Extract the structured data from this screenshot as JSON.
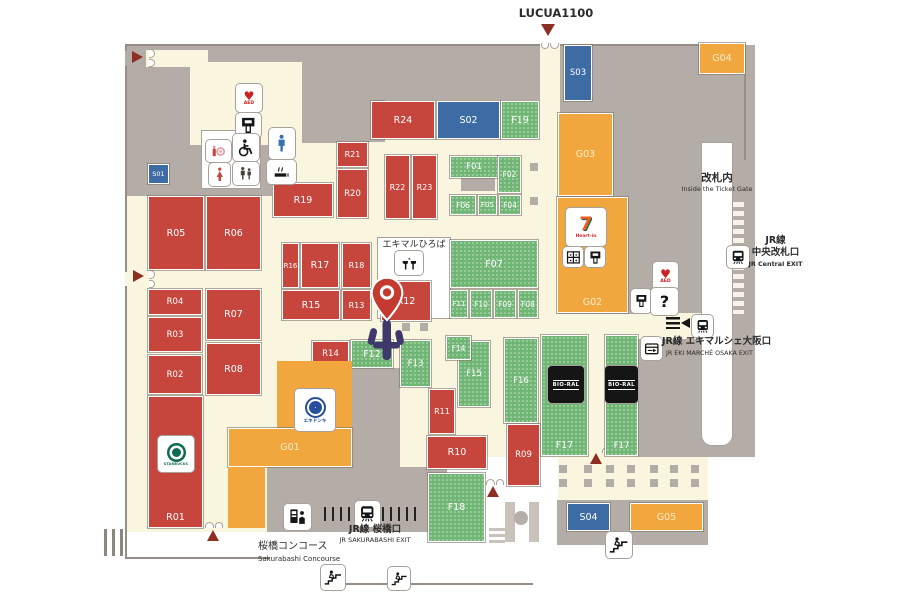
{
  "colors": {
    "red": "#c6463e",
    "green": "#6fb573",
    "blue": "#3d6ba3",
    "orange": "#f1a73e",
    "gray": "#b4aca6",
    "cream": "#faf5de",
    "arrow": "#8e2f23"
  },
  "icon_glyphs": {
    "question": "?",
    "aed_heart": "♥",
    "aed_label": "AED"
  },
  "regions": [
    {
      "c": "cream",
      "x": 125,
      "y": 45,
      "w": 630,
      "h": 487,
      "n": "map-base"
    },
    {
      "c": "gray",
      "x": 125,
      "y": 45,
      "w": 415,
      "h": 55,
      "n": "backarea-top"
    },
    {
      "c": "gray",
      "x": 125,
      "y": 68,
      "w": 65,
      "h": 128,
      "n": "backarea-left"
    },
    {
      "c": "gray",
      "x": 302,
      "y": 100,
      "w": 35,
      "h": 43,
      "n": "backarea-a"
    },
    {
      "c": "gray",
      "x": 337,
      "y": 100,
      "w": 48,
      "h": 42,
      "n": "backarea-b"
    },
    {
      "c": "gray",
      "x": 190,
      "y": 143,
      "w": 84,
      "h": 53,
      "n": "backarea-c"
    },
    {
      "c": "gray",
      "x": 558,
      "y": 45,
      "w": 197,
      "h": 412,
      "n": "backarea-right"
    },
    {
      "c": "gray",
      "x": 461,
      "y": 178,
      "w": 34,
      "h": 13,
      "n": "backarea-f01"
    },
    {
      "c": "gray",
      "x": 352,
      "y": 368,
      "w": 48,
      "h": 105,
      "n": "backarea-center"
    },
    {
      "c": "cream",
      "x": 146,
      "y": 50,
      "w": 62,
      "h": 17,
      "n": "corridor-topleft"
    },
    {
      "c": "cream",
      "x": 190,
      "y": 62,
      "w": 84,
      "h": 83,
      "n": "corridor-left"
    },
    {
      "c": "cream",
      "x": 272,
      "y": 62,
      "w": 30,
      "h": 163,
      "n": "corridor-vertical"
    },
    {
      "c": "cream",
      "x": 540,
      "y": 45,
      "w": 20,
      "h": 178,
      "n": "corridor-lucua"
    },
    {
      "c": "cream",
      "x": 558,
      "y": 314,
      "w": 80,
      "h": 144,
      "n": "concourse-right"
    },
    {
      "c": "cream",
      "x": 638,
      "y": 313,
      "w": 70,
      "h": 26,
      "n": "corridor-exit"
    },
    {
      "c": "gray",
      "x": 267,
      "y": 467,
      "w": 180,
      "h": 65,
      "n": "concourse-sakurabashi"
    },
    {
      "c": "white",
      "x": 447,
      "y": 457,
      "w": 111,
      "h": 75,
      "n": "stairwell-area"
    },
    {
      "c": "white",
      "x": 708,
      "y": 457,
      "w": 47,
      "h": 75,
      "n": "right-lower-bg"
    },
    {
      "c": "white outl",
      "x": 702,
      "y": 143,
      "w": 30,
      "h": 302,
      "n": "inside-gate-strip"
    },
    {
      "c": "white outl",
      "x": 202,
      "y": 131,
      "w": 58,
      "h": 57,
      "n": "restroom-panel"
    },
    {
      "c": "white outl",
      "x": 378,
      "y": 238,
      "w": 72,
      "h": 80,
      "n": "plaza-area"
    },
    {
      "c": "gray",
      "x": 557,
      "y": 500,
      "w": 151,
      "h": 45,
      "n": "south-shop-base"
    },
    {
      "c": "esc",
      "x": 505,
      "y": 502,
      "w": 10,
      "h": 40,
      "n": "stairwell-rail-left"
    },
    {
      "c": "esc",
      "x": 529,
      "y": 502,
      "w": 10,
      "h": 40,
      "n": "stairwell-rail-right"
    },
    {
      "c": "esc-c",
      "x": 514,
      "y": 511,
      "w": 14,
      "h": 14,
      "n": "stairwell-pillar"
    },
    {
      "c": "esc",
      "x": 489,
      "y": 528,
      "w": 16,
      "h": 3,
      "n": "stairwell-step-1"
    },
    {
      "c": "esc",
      "x": 489,
      "y": 534,
      "w": 16,
      "h": 3,
      "n": "stairwell-step-2"
    },
    {
      "c": "esc",
      "x": 489,
      "y": 540,
      "w": 16,
      "h": 3,
      "n": "stairwell-step-3"
    },
    {
      "c": "dashcol",
      "x": 733,
      "y": 202,
      "w": 11,
      "h": 112,
      "n": "central-gate-dashes"
    },
    {
      "c": "vbars",
      "x": 324,
      "y": 507,
      "w": 30,
      "h": 14,
      "n": "sakurabashi-gate-bars-left"
    },
    {
      "c": "vbars",
      "x": 382,
      "y": 507,
      "w": 39,
      "h": 14,
      "n": "sakurabashi-gate-bars-right"
    },
    {
      "c": "vbars2",
      "x": 104,
      "y": 529,
      "w": 20,
      "h": 27,
      "n": "left-gate-bars"
    },
    {
      "c": "line",
      "x": 125,
      "y": 44,
      "w": 415,
      "h": 2,
      "n": "boundary-top-1"
    },
    {
      "c": "line",
      "x": 560,
      "y": 44,
      "w": 185,
      "h": 2,
      "n": "boundary-top-2"
    },
    {
      "c": "line",
      "x": 125,
      "y": 44,
      "w": 2,
      "h": 7,
      "n": "boundary-left-1"
    },
    {
      "c": "line",
      "x": 125,
      "y": 66,
      "w": 2,
      "h": 206,
      "n": "boundary-left-2"
    },
    {
      "c": "line",
      "x": 125,
      "y": 286,
      "w": 2,
      "h": 273,
      "n": "boundary-left-3"
    },
    {
      "c": "line",
      "x": 125,
      "y": 557,
      "w": 145,
      "h": 2,
      "n": "boundary-bottom-1"
    },
    {
      "c": "line",
      "x": 343,
      "y": 583,
      "w": 190,
      "h": 2,
      "n": "boundary-bottom-2"
    },
    {
      "c": "line",
      "x": 744,
      "y": 44,
      "w": 2,
      "h": 116,
      "n": "boundary-right"
    }
  ],
  "blocks": [
    {
      "id": "R05",
      "t": "r",
      "x": 148,
      "y": 196,
      "w": 56,
      "h": 74
    },
    {
      "id": "R06",
      "t": "r",
      "x": 206,
      "y": 196,
      "w": 55,
      "h": 74
    },
    {
      "id": "R04",
      "t": "r",
      "x": 148,
      "y": 289,
      "w": 54,
      "h": 26,
      "fs": 8.5
    },
    {
      "id": "R07",
      "t": "r",
      "x": 206,
      "y": 289,
      "w": 55,
      "h": 51
    },
    {
      "id": "R03",
      "t": "r",
      "x": 148,
      "y": 317,
      "w": 54,
      "h": 35,
      "fs": 8.5
    },
    {
      "id": "R02",
      "t": "r",
      "x": 148,
      "y": 355,
      "w": 54,
      "h": 39,
      "fs": 8.5
    },
    {
      "id": "R08",
      "t": "r",
      "x": 206,
      "y": 343,
      "w": 55,
      "h": 52
    },
    {
      "id": "R01",
      "t": "r",
      "x": 148,
      "y": 396,
      "w": 55,
      "h": 132,
      "lp": "b"
    },
    {
      "id": "R19",
      "t": "r",
      "x": 273,
      "y": 183,
      "w": 60,
      "h": 34
    },
    {
      "id": "R21",
      "t": "r",
      "x": 337,
      "y": 142,
      "w": 31,
      "h": 25,
      "fs": 8
    },
    {
      "id": "R20",
      "t": "r",
      "x": 337,
      "y": 169,
      "w": 31,
      "h": 49,
      "fs": 8.5
    },
    {
      "id": "R22",
      "t": "r",
      "x": 385,
      "y": 155,
      "w": 25,
      "h": 64,
      "fs": 8
    },
    {
      "id": "R23",
      "t": "r",
      "x": 412,
      "y": 155,
      "w": 25,
      "h": 64,
      "fs": 8
    },
    {
      "id": "R24",
      "t": "r",
      "x": 371,
      "y": 101,
      "w": 64,
      "h": 38
    },
    {
      "id": "R16",
      "t": "r",
      "x": 282,
      "y": 243,
      "w": 17,
      "h": 45,
      "fs": 7
    },
    {
      "id": "R17",
      "t": "r",
      "x": 301,
      "y": 243,
      "w": 38,
      "h": 45
    },
    {
      "id": "R18",
      "t": "r",
      "x": 342,
      "y": 243,
      "w": 29,
      "h": 45,
      "fs": 8
    },
    {
      "id": "R15",
      "t": "r",
      "x": 282,
      "y": 290,
      "w": 58,
      "h": 30
    },
    {
      "id": "R13",
      "t": "r",
      "x": 342,
      "y": 290,
      "w": 29,
      "h": 30,
      "fs": 8
    },
    {
      "id": "R14",
      "t": "r",
      "x": 312,
      "y": 341,
      "w": 37,
      "h": 26,
      "fs": 8.5
    },
    {
      "id": "R12",
      "t": "r",
      "x": 381,
      "y": 281,
      "w": 50,
      "h": 40
    },
    {
      "id": "F13",
      "t": "f",
      "x": 400,
      "y": 340,
      "w": 31,
      "h": 47,
      "fs": 8.5
    },
    {
      "id": "R11",
      "t": "r",
      "x": 429,
      "y": 389,
      "w": 26,
      "h": 45,
      "fs": 8
    },
    {
      "id": "R10",
      "t": "r",
      "x": 427,
      "y": 436,
      "w": 60,
      "h": 33
    },
    {
      "id": "R09",
      "t": "r",
      "x": 507,
      "y": 424,
      "w": 33,
      "h": 62,
      "fs": 8.5
    },
    {
      "id": "S01",
      "t": "s",
      "x": 148,
      "y": 164,
      "w": 21,
      "h": 20,
      "fs": 6.5
    },
    {
      "id": "S02",
      "t": "s",
      "x": 437,
      "y": 101,
      "w": 63,
      "h": 38
    },
    {
      "id": "S03",
      "t": "s",
      "x": 564,
      "y": 45,
      "w": 28,
      "h": 56,
      "fs": 8.5
    },
    {
      "id": "S04",
      "t": "s",
      "x": 567,
      "y": 503,
      "w": 43,
      "h": 28
    },
    {
      "id": "F19",
      "t": "f",
      "x": 501,
      "y": 101,
      "w": 38,
      "h": 38
    },
    {
      "id": "F01",
      "t": "f",
      "x": 450,
      "y": 156,
      "w": 48,
      "h": 22,
      "fs": 8.5
    },
    {
      "id": "F02",
      "t": "f",
      "x": 498,
      "y": 156,
      "w": 23,
      "h": 37,
      "fs": 7.5
    },
    {
      "id": "F06",
      "t": "f",
      "x": 450,
      "y": 195,
      "w": 26,
      "h": 20,
      "fs": 7.5
    },
    {
      "id": "F05",
      "t": "f",
      "x": 478,
      "y": 195,
      "w": 19,
      "h": 20,
      "fs": 7
    },
    {
      "id": "F04",
      "t": "f",
      "x": 499,
      "y": 195,
      "w": 22,
      "h": 20,
      "fs": 7.5
    },
    {
      "id": "F07",
      "t": "f",
      "x": 450,
      "y": 240,
      "w": 88,
      "h": 48
    },
    {
      "id": "F11",
      "t": "f",
      "x": 450,
      "y": 290,
      "w": 18,
      "h": 28,
      "fs": 7
    },
    {
      "id": "F10",
      "t": "f",
      "x": 470,
      "y": 290,
      "w": 22,
      "h": 28,
      "fs": 7.5
    },
    {
      "id": "F09",
      "t": "f",
      "x": 494,
      "y": 290,
      "w": 22,
      "h": 28,
      "fs": 7.5
    },
    {
      "id": "F08",
      "t": "f",
      "x": 518,
      "y": 290,
      "w": 20,
      "h": 28,
      "fs": 7.5
    },
    {
      "id": "F12",
      "t": "f",
      "x": 351,
      "y": 340,
      "w": 42,
      "h": 28
    },
    {
      "id": "F15",
      "t": "f",
      "x": 458,
      "y": 341,
      "w": 32,
      "h": 66,
      "fs": 8.5
    },
    {
      "id": "F14",
      "t": "f",
      "x": 446,
      "y": 336,
      "w": 25,
      "h": 24,
      "fs": 7.5
    },
    {
      "id": "F16",
      "t": "f",
      "x": 504,
      "y": 338,
      "w": 34,
      "h": 85,
      "fs": 8.5
    },
    {
      "id": "F17",
      "t": "f",
      "x": 541,
      "y": 335,
      "w": 47,
      "h": 121,
      "lp": "b"
    },
    {
      "id": "F17",
      "t": "f",
      "x": 605,
      "y": 335,
      "w": 33,
      "h": 121,
      "lp": "b",
      "fs": 8.5
    },
    {
      "id": "F18",
      "t": "f",
      "x": 428,
      "y": 473,
      "w": 57,
      "h": 69
    },
    {
      "id": "G03",
      "t": "g",
      "x": 558,
      "y": 113,
      "w": 55,
      "h": 83
    },
    {
      "id": "G02",
      "t": "g",
      "x": 557,
      "y": 197,
      "w": 71,
      "h": 116,
      "lp": "b"
    },
    {
      "id": "G04",
      "t": "g",
      "x": 699,
      "y": 43,
      "w": 46,
      "h": 31
    },
    {
      "id": "G05",
      "t": "g",
      "x": 630,
      "y": 503,
      "w": 73,
      "h": 28
    },
    {
      "id": "G01",
      "t": "g",
      "x": 277,
      "y": 361,
      "w": 75,
      "h": 67,
      "nl": true
    },
    {
      "id": "G01",
      "t": "g",
      "x": 228,
      "y": 428,
      "w": 124,
      "h": 39
    },
    {
      "id": "G01",
      "t": "g",
      "x": 228,
      "y": 467,
      "w": 37,
      "h": 61,
      "nl": true
    }
  ],
  "labels": [
    {
      "t": "LUCUA1100",
      "x": 516,
      "y": 7,
      "w": 80,
      "fs": 11.5,
      "b": 1,
      "a": "center"
    },
    {
      "t": "エキマルひろば",
      "x": 377,
      "y": 240,
      "w": 74,
      "fs": 9,
      "b": 0,
      "a": "center"
    },
    {
      "t": "改札内",
      "x": 687,
      "y": 172,
      "w": 60,
      "fs": 10.5,
      "b": 1,
      "a": "center"
    },
    {
      "t": "Inside the Ticket Gate",
      "x": 672,
      "y": 186,
      "w": 90,
      "fs": 6.5,
      "b": 0,
      "a": "center"
    },
    {
      "t": "JR線",
      "x": 748,
      "y": 236,
      "w": 55,
      "fs": 9.5,
      "b": 1,
      "a": "center"
    },
    {
      "t": "中央改札口",
      "x": 748,
      "y": 248,
      "w": 55,
      "fs": 9.5,
      "b": 1,
      "a": "center"
    },
    {
      "t": "JR Central EXIT",
      "x": 748,
      "y": 261,
      "w": 55,
      "fs": 6.4,
      "b": 1,
      "a": "center"
    },
    {
      "t": "JR線 エキマルシェ大阪口",
      "x": 662,
      "y": 337,
      "w": 140,
      "fs": 9.5,
      "b": 1,
      "a": "left"
    },
    {
      "t": "JR EKI MARCHÉ OSAKA EXIT",
      "x": 666,
      "y": 350,
      "w": 140,
      "fs": 6.3,
      "b": 0,
      "a": "left"
    },
    {
      "t": "JR線 桜橋口",
      "x": 330,
      "y": 525,
      "w": 90,
      "fs": 9.5,
      "b": 1,
      "a": "center"
    },
    {
      "t": "JR SAKURABASHI EXIT",
      "x": 325,
      "y": 537,
      "w": 100,
      "fs": 6.5,
      "b": 0,
      "a": "center"
    },
    {
      "t": "桜橋コンコース",
      "x": 258,
      "y": 541,
      "w": 110,
      "fs": 10,
      "b": 0,
      "a": "left"
    },
    {
      "t": "Sakurabashi Concourse",
      "x": 258,
      "y": 555,
      "w": 110,
      "fs": 7,
      "b": 0,
      "a": "left"
    }
  ],
  "icons": [
    {
      "k": "aed",
      "x": 236,
      "y": 84,
      "w": 26,
      "h": 28,
      "n": "aed-icon"
    },
    {
      "k": "atm",
      "x": 236,
      "y": 113,
      "w": 25,
      "h": 25,
      "n": "atm-icon"
    },
    {
      "k": "powder",
      "x": 206,
      "y": 140,
      "w": 25,
      "h": 22,
      "n": "powder-room-icon"
    },
    {
      "k": "wheelchair",
      "x": 233,
      "y": 134,
      "w": 26,
      "h": 27,
      "n": "wheelchair-icon"
    },
    {
      "k": "woman",
      "x": 209,
      "y": 163,
      "w": 21,
      "h": 23,
      "n": "womens-toilet-icon"
    },
    {
      "k": "family",
      "x": 233,
      "y": 162,
      "w": 26,
      "h": 23,
      "n": "family-toilet-icon"
    },
    {
      "k": "man",
      "x": 269,
      "y": 128,
      "w": 26,
      "h": 31,
      "n": "mens-toilet-icon"
    },
    {
      "k": "smoking",
      "x": 267,
      "y": 160,
      "w": 29,
      "h": 24,
      "n": "smoking-area-icon"
    },
    {
      "k": "fountain",
      "x": 395,
      "y": 251,
      "w": 28,
      "h": 24,
      "n": "fountain-icon"
    },
    {
      "k": "locker",
      "x": 563,
      "y": 247,
      "w": 20,
      "h": 20,
      "n": "coin-locker-icon"
    },
    {
      "k": "atm",
      "x": 585,
      "y": 247,
      "w": 20,
      "h": 20,
      "n": "atm-icon-2"
    },
    {
      "k": "aed",
      "x": 653,
      "y": 262,
      "w": 25,
      "h": 28,
      "n": "aed-icon-2"
    },
    {
      "k": "atm",
      "x": 631,
      "y": 289,
      "w": 20,
      "h": 24,
      "n": "atm-icon-3"
    },
    {
      "k": "question",
      "x": 651,
      "y": 288,
      "w": 27,
      "h": 27,
      "n": "information-icon"
    },
    {
      "k": "train",
      "x": 727,
      "y": 246,
      "w": 22,
      "h": 22,
      "n": "train-icon-central"
    },
    {
      "k": "tribars",
      "x": 666,
      "y": 317,
      "w": 14,
      "h": 12,
      "n": "gate-bars-icon"
    },
    {
      "k": "tril",
      "x": 681,
      "y": 318,
      "w": 10,
      "h": 11,
      "n": "left-arrow-icon"
    },
    {
      "k": "train",
      "x": 692,
      "y": 315,
      "w": 21,
      "h": 22,
      "n": "train-icon-exit"
    },
    {
      "k": "gate",
      "x": 641,
      "y": 337,
      "w": 21,
      "h": 23,
      "n": "ticket-gate-machine-icon"
    },
    {
      "k": "train",
      "x": 355,
      "y": 501,
      "w": 25,
      "h": 26,
      "n": "train-icon-sakurabashi"
    },
    {
      "k": "tvm",
      "x": 284,
      "y": 504,
      "w": 27,
      "h": 26,
      "n": "ticket-machine-icon"
    },
    {
      "k": "stairs",
      "x": 321,
      "y": 565,
      "w": 24,
      "h": 25,
      "n": "stairs-icon-1"
    },
    {
      "k": "stairs",
      "x": 388,
      "y": 567,
      "w": 22,
      "h": 23,
      "n": "stairs-icon-2"
    },
    {
      "k": "stairs",
      "x": 606,
      "y": 532,
      "w": 26,
      "h": 26,
      "n": "stairs-icon-3"
    }
  ],
  "logos": [
    {
      "k": "starbucks",
      "x": 158,
      "y": 436,
      "w": 36,
      "h": 36,
      "label": "STARBUCKS",
      "n": "starbucks-logo"
    },
    {
      "k": "seven",
      "x": 566,
      "y": 208,
      "w": 40,
      "h": 38,
      "l1": "7",
      "l2": "Heart-in",
      "n": "seven-eleven-logo"
    },
    {
      "k": "ekidonki",
      "x": 295,
      "y": 389,
      "w": 40,
      "h": 42,
      "label": "エキドンキ",
      "n": "ekidonki-logo"
    },
    {
      "k": "bioral",
      "x": 548,
      "y": 366,
      "w": 36,
      "h": 37,
      "label": "BIO-RAL",
      "n": "bioral-logo-1"
    },
    {
      "k": "bioral",
      "x": 605,
      "y": 366,
      "w": 33,
      "h": 37,
      "label": "BIO-RAL",
      "n": "bioral-logo-2"
    }
  ],
  "arrows": [
    {
      "d": "right",
      "x": 132,
      "y": 51,
      "n": "entrance-arrow-left-top"
    },
    {
      "d": "right",
      "x": 133,
      "y": 270,
      "n": "entrance-arrow-left-mid"
    },
    {
      "d": "down",
      "x": 541,
      "y": 24,
      "n": "entrance-arrow-lucua"
    },
    {
      "d": "up",
      "x": 207,
      "y": 530,
      "n": "entrance-arrow-sakurabashi"
    },
    {
      "d": "up",
      "x": 487,
      "y": 486,
      "n": "entrance-arrow-south-1"
    },
    {
      "d": "up",
      "x": 590,
      "y": 453,
      "n": "entrance-arrow-south-2"
    }
  ],
  "arches": [
    {
      "x": 142,
      "y": 54,
      "r": 90
    },
    {
      "x": 142,
      "y": 275,
      "r": 90
    },
    {
      "x": 541,
      "y": 41,
      "r": 180
    },
    {
      "x": 205,
      "y": 522,
      "r": 0
    },
    {
      "x": 486,
      "y": 479,
      "r": 0
    },
    {
      "x": 602,
      "y": 447,
      "r": 0
    }
  ],
  "pillars": [
    [
      559,
      465
    ],
    [
      584,
      465
    ],
    [
      606,
      465
    ],
    [
      627,
      465
    ],
    [
      650,
      465
    ],
    [
      670,
      465
    ],
    [
      691,
      465
    ],
    [
      559,
      479
    ],
    [
      584,
      479
    ],
    [
      606,
      479
    ],
    [
      627,
      479
    ],
    [
      650,
      479
    ],
    [
      670,
      479
    ],
    [
      691,
      479
    ],
    [
      530,
      163
    ],
    [
      530,
      197
    ],
    [
      402,
      323
    ],
    [
      420,
      323
    ]
  ],
  "markers": {
    "pin": {
      "x": 370,
      "y": 276,
      "w": 34,
      "h": 46,
      "n": "current-location-pin"
    },
    "statue": {
      "x": 366,
      "y": 316,
      "w": 40,
      "h": 46,
      "n": "landmark-statue"
    }
  }
}
